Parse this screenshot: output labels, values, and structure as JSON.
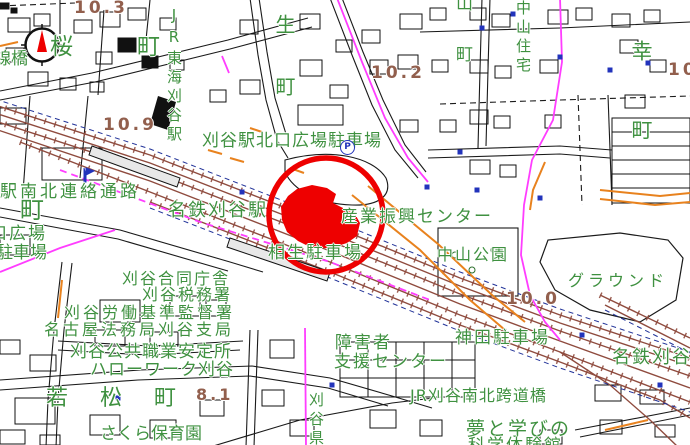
{
  "map": {
    "title_hint": "city-gis-map-kariya-station-area",
    "colors": {
      "label_green": "#3f9140",
      "elevation_brown": "#925f4d",
      "railway_brown": "#8f4b3e",
      "boundary_magenta": "#ff3dff",
      "road_orange": "#e8821e",
      "symbol_blue": "#2233bb",
      "highlight_red": "#ee0000",
      "line_black": "#1a1a1a",
      "background": "#ffffff"
    },
    "labels": {
      "elev_10_3": "10.3",
      "elev_10_9": "10.9",
      "elev_10_2": "10.2",
      "elev_10": "10",
      "elev_10_0": "10.0",
      "elev_8_1": "8.1",
      "sakura_cho": "桜町",
      "senkyo_bashi": "線橋",
      "jr_tokai_kariya_sta": "JR東海刈谷駅",
      "kitaguchi_parking": "刈谷駅北口広場駐車場",
      "parking_symbol": "P",
      "renraku_tsuro": "駅南北連絡通路",
      "machi": "町",
      "kuchi_hiroba": "口広場",
      "chushajo": "駐車場",
      "meitetsu_kariya_sta": "名鉄刈谷駅",
      "sangyo_shinko_center": "産業振興センター",
      "aioi_parking": "相生駐車場",
      "nakayama_park": "中山公園",
      "nakayama_jutaku": "中山住宅",
      "yama_cho": "山町",
      "sei_cho": "生町",
      "saiwai_cho": "幸町",
      "ground": "グラウンド",
      "godochosha": "刈谷合同庁舎",
      "zeimusho": "刈谷税務署",
      "rodo_kijun": "刈谷労働基準監督署",
      "homukyoku": "名古屋法務局刈谷支局",
      "shokugyo_anteisho": "刈谷公共職業安定所",
      "hellowork": "ハローワーク刈谷",
      "wakamatsu_cho": "若松町",
      "sakura_hoikuen": "さくら保育園",
      "shogaisha": "障害者",
      "shien_center": "支援センター",
      "kariya_ken": "刈谷県",
      "kanda_parking": "神田駐車場",
      "kodokyo": "JR刈谷南北跨道橋",
      "meitetsu_kariya": "名鉄刈谷",
      "yume_to_manabi": "夢と学びの",
      "kagaku_taikenkan": "科学体験館"
    }
  }
}
